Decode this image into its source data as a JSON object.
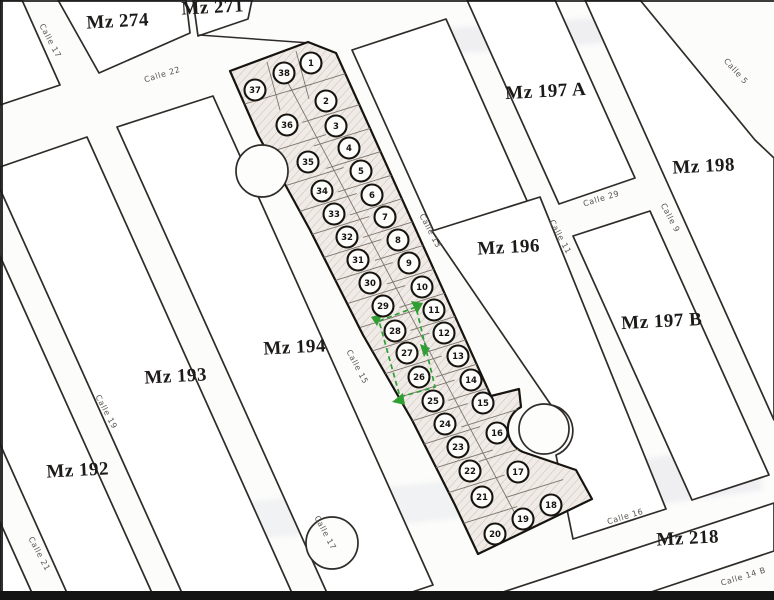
{
  "map": {
    "type": "cadastral-subdivision-plan",
    "colors": {
      "line": "#2e2b28",
      "paper": "#fcfcfb",
      "strip_fill": "#f0ebe6",
      "hatch": "#c9c0b8",
      "selection": "#2f9e33"
    },
    "blocks": [
      {
        "id": "mz-274",
        "label": "Mz 274",
        "x": 118,
        "y": 27
      },
      {
        "id": "mz-271",
        "label": "Mz 271",
        "x": 213,
        "y": 13
      },
      {
        "id": "mz-197-a",
        "label": "Mz 197 A",
        "x": 546,
        "y": 97
      },
      {
        "id": "mz-198",
        "label": "Mz 198",
        "x": 704,
        "y": 172
      },
      {
        "id": "mz-196",
        "label": "Mz 196",
        "x": 509,
        "y": 253
      },
      {
        "id": "mz-197-b",
        "label": "Mz 197 B",
        "x": 662,
        "y": 327
      },
      {
        "id": "mz-194",
        "label": "Mz 194",
        "x": 295,
        "y": 353
      },
      {
        "id": "mz-193",
        "label": "Mz 193",
        "x": 176,
        "y": 382
      },
      {
        "id": "mz-192",
        "label": "Mz 192",
        "x": 78,
        "y": 476
      },
      {
        "id": "mz-218",
        "label": "Mz 218",
        "x": 688,
        "y": 544
      }
    ],
    "streets": [
      {
        "id": "calle-22",
        "name": "Calle 22",
        "x": 163,
        "y": 77,
        "rot": -17
      },
      {
        "id": "calle-29",
        "name": "Calle 29",
        "x": 602,
        "y": 201,
        "rot": -17
      },
      {
        "id": "calle-16",
        "name": "Calle 16",
        "x": 626,
        "y": 519,
        "rot": -17
      },
      {
        "id": "calle-14-b",
        "name": "Calle 14 B",
        "x": 744,
        "y": 579,
        "rot": -17
      },
      {
        "id": "calle-17-north",
        "name": "Calle 17",
        "x": 48,
        "y": 42,
        "rot": 62
      },
      {
        "id": "calle-17-south",
        "name": "Calle 17",
        "x": 323,
        "y": 534,
        "rot": 62
      },
      {
        "id": "calle-19",
        "name": "Calle 19",
        "x": 104,
        "y": 413,
        "rot": 62
      },
      {
        "id": "calle-21",
        "name": "Calle 21",
        "x": 37,
        "y": 555,
        "rot": 62
      },
      {
        "id": "calle-15",
        "name": "Calle 15",
        "x": 355,
        "y": 368,
        "rot": 62
      },
      {
        "id": "calle-13",
        "name": "Calle 13",
        "x": 428,
        "y": 232,
        "rot": 62
      },
      {
        "id": "calle-11",
        "name": "Calle 11",
        "x": 558,
        "y": 238,
        "rot": 62
      },
      {
        "id": "calle-9",
        "name": "Calle 9",
        "x": 668,
        "y": 219,
        "rot": 62
      },
      {
        "id": "calle-5",
        "name": "Calle 5",
        "x": 734,
        "y": 73,
        "rot": 48
      }
    ],
    "lots": [
      {
        "n": 1,
        "x": 311,
        "y": 63
      },
      {
        "n": 2,
        "x": 326,
        "y": 101
      },
      {
        "n": 3,
        "x": 336,
        "y": 126
      },
      {
        "n": 4,
        "x": 349,
        "y": 148
      },
      {
        "n": 5,
        "x": 361,
        "y": 171
      },
      {
        "n": 6,
        "x": 372,
        "y": 195
      },
      {
        "n": 7,
        "x": 385,
        "y": 217
      },
      {
        "n": 8,
        "x": 398,
        "y": 240
      },
      {
        "n": 9,
        "x": 409,
        "y": 263
      },
      {
        "n": 10,
        "x": 422,
        "y": 287
      },
      {
        "n": 11,
        "x": 434,
        "y": 310
      },
      {
        "n": 12,
        "x": 444,
        "y": 333
      },
      {
        "n": 13,
        "x": 458,
        "y": 356
      },
      {
        "n": 14,
        "x": 471,
        "y": 380
      },
      {
        "n": 15,
        "x": 483,
        "y": 403
      },
      {
        "n": 16,
        "x": 497,
        "y": 433
      },
      {
        "n": 17,
        "x": 518,
        "y": 472
      },
      {
        "n": 18,
        "x": 551,
        "y": 505
      },
      {
        "n": 19,
        "x": 523,
        "y": 519
      },
      {
        "n": 20,
        "x": 495,
        "y": 534
      },
      {
        "n": 21,
        "x": 482,
        "y": 497
      },
      {
        "n": 22,
        "x": 470,
        "y": 471
      },
      {
        "n": 23,
        "x": 458,
        "y": 447
      },
      {
        "n": 24,
        "x": 445,
        "y": 424
      },
      {
        "n": 25,
        "x": 433,
        "y": 401
      },
      {
        "n": 26,
        "x": 419,
        "y": 377
      },
      {
        "n": 27,
        "x": 407,
        "y": 353
      },
      {
        "n": 28,
        "x": 395,
        "y": 331
      },
      {
        "n": 29,
        "x": 383,
        "y": 306
      },
      {
        "n": 30,
        "x": 370,
        "y": 283
      },
      {
        "n": 31,
        "x": 358,
        "y": 260
      },
      {
        "n": 32,
        "x": 347,
        "y": 237
      },
      {
        "n": 33,
        "x": 334,
        "y": 214
      },
      {
        "n": 34,
        "x": 322,
        "y": 191
      },
      {
        "n": 35,
        "x": 308,
        "y": 162
      },
      {
        "n": 36,
        "x": 287,
        "y": 125
      },
      {
        "n": 37,
        "x": 255,
        "y": 90
      },
      {
        "n": 38,
        "x": 284,
        "y": 73
      }
    ],
    "selection": {
      "highlighted_lots": [
        26,
        27,
        28
      ],
      "color": "#2f9e33"
    }
  }
}
